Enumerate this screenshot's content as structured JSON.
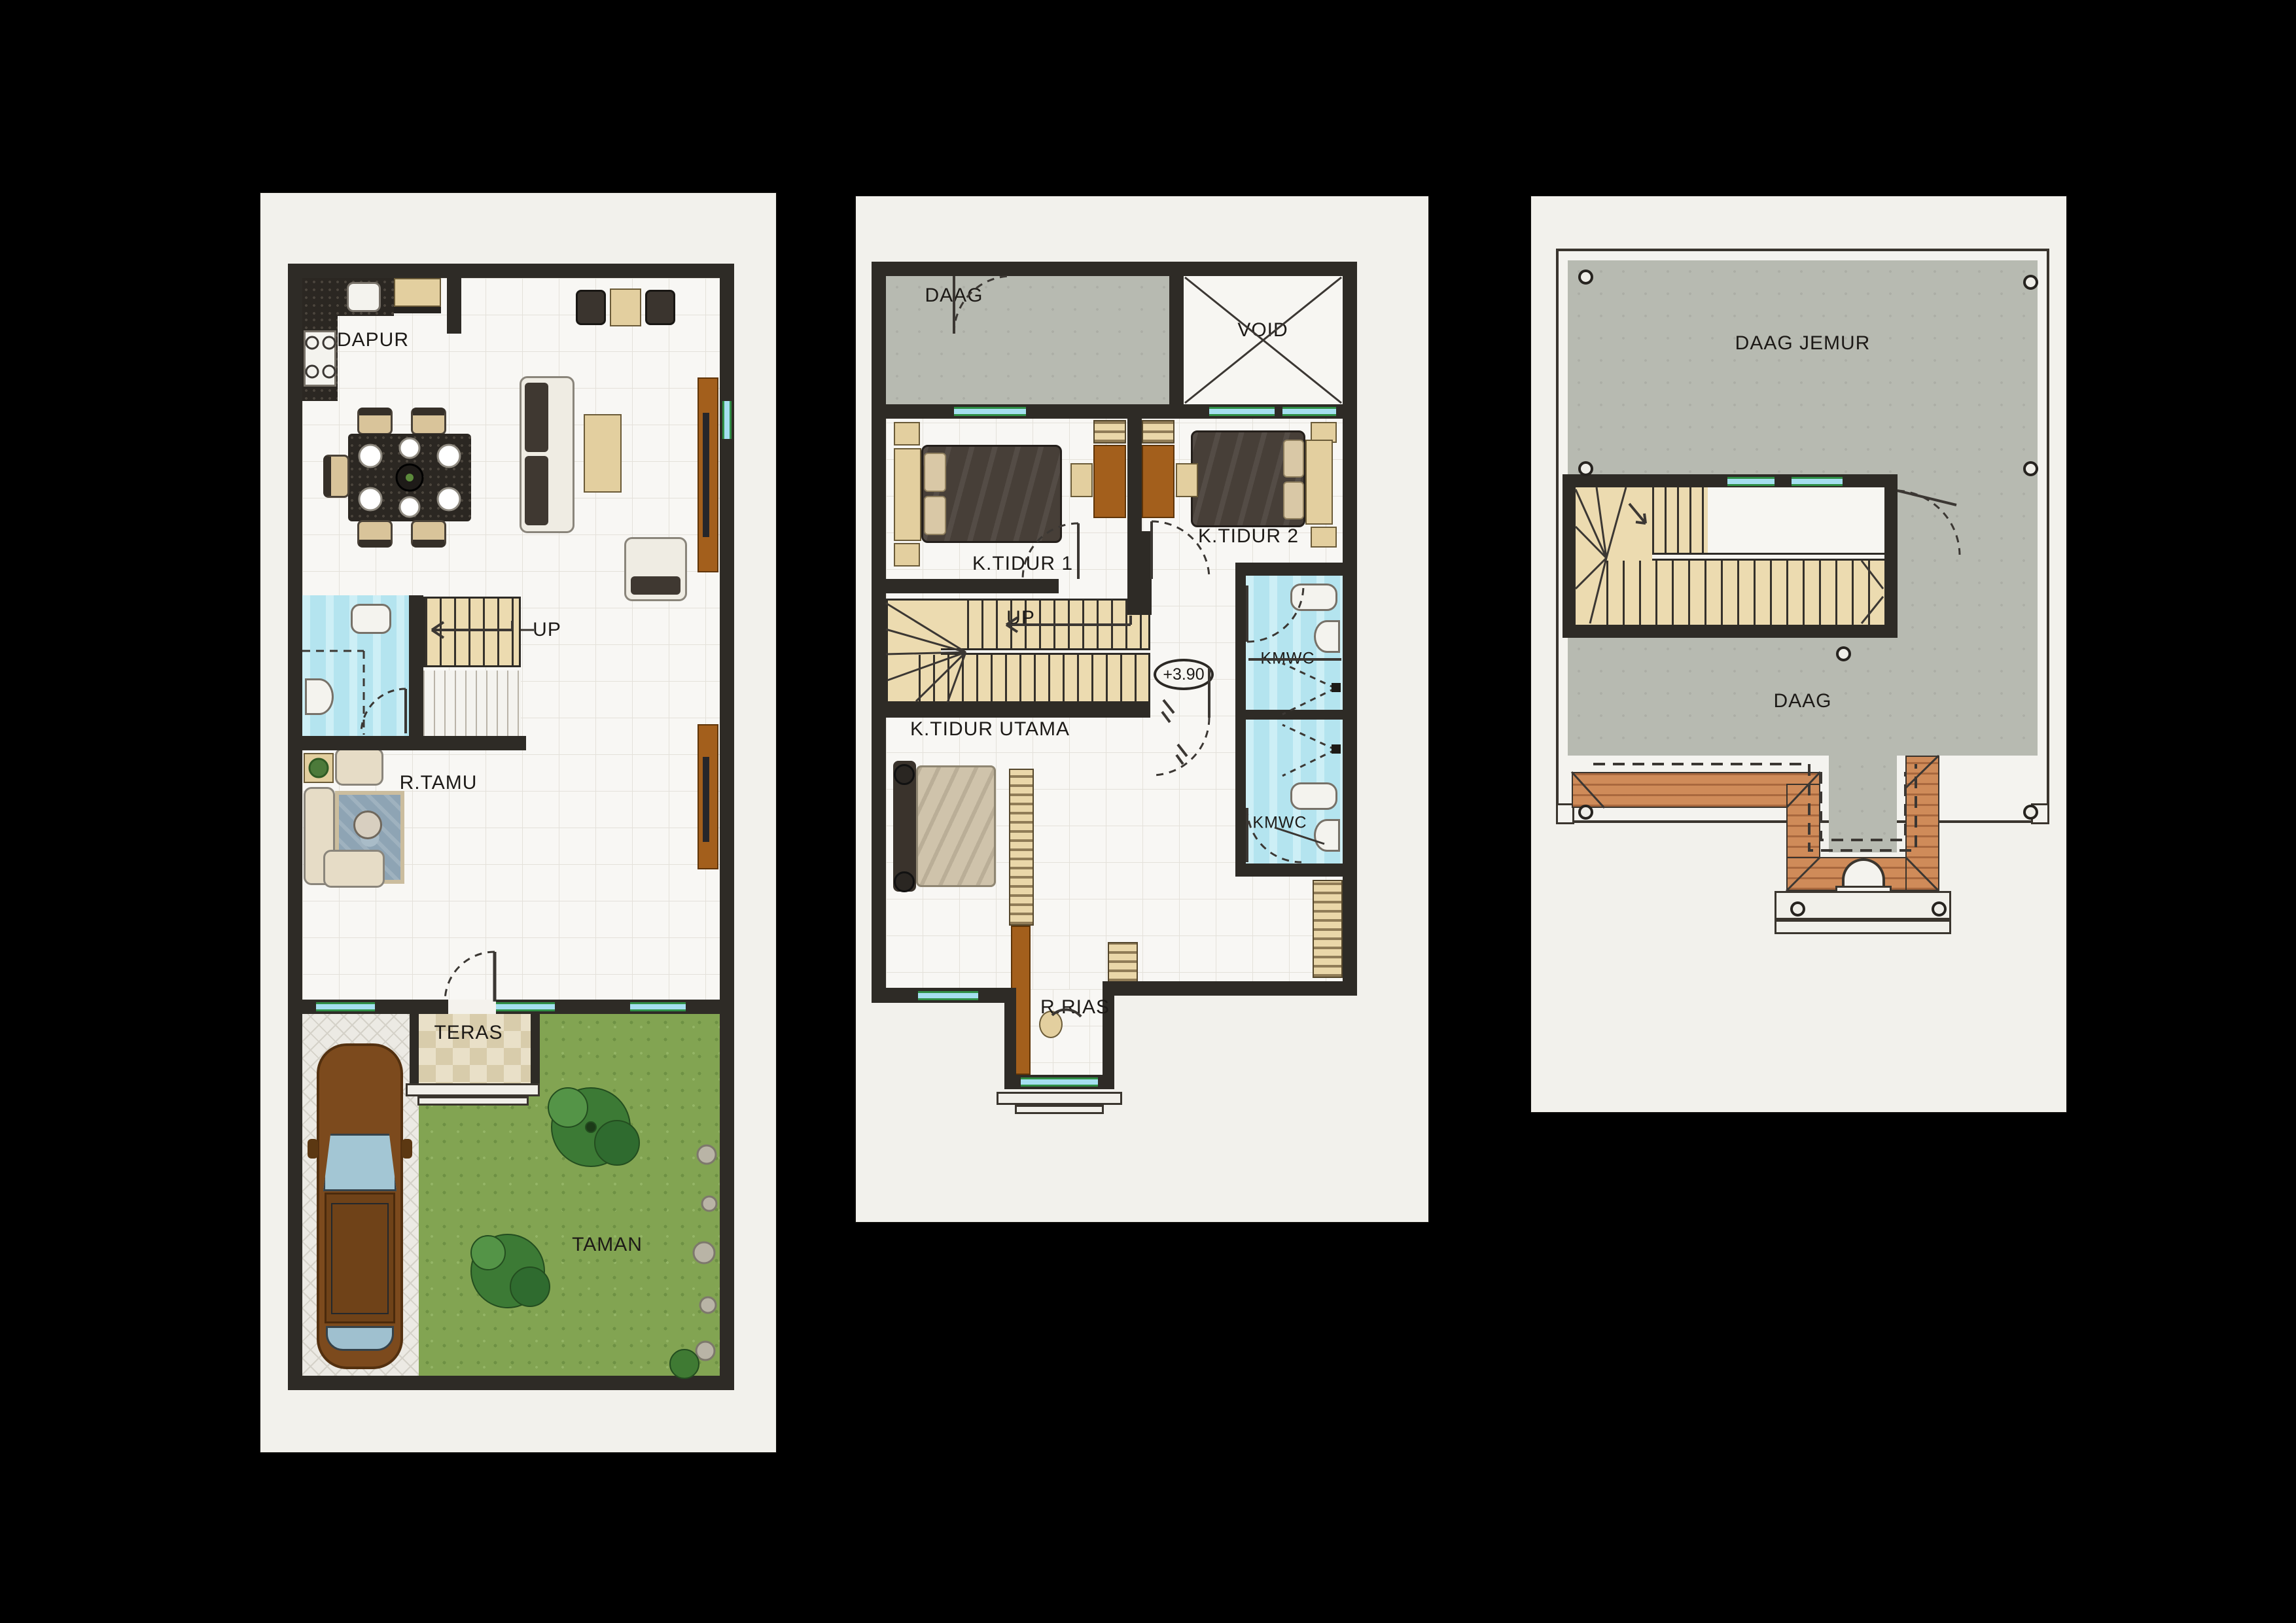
{
  "document_type": "house-floor-plan-sheet",
  "colors": {
    "background": "#000000",
    "paper": "#f2f1ec",
    "wall": "#2e2b26",
    "floor_grid": "#e4e1da",
    "bathroom_cyan": "#bfe9f2",
    "window_glass": "#a5dff0",
    "window_frame": "#2f8f46",
    "stair_tan": "#ecdbb0",
    "counter_granite": "#2b2722",
    "wood_brown": "#a35f1c",
    "bed_dark": "#473f38",
    "master_bed": "#cfc3ab",
    "concrete_gray": "#b7bab1",
    "terracotta_roof": "#cf8b59",
    "grass_green": "#82a452",
    "car_brown": "#7c4a1d",
    "rug_blue": "#8ea4b4"
  },
  "panels": [
    {
      "labels": {
        "dapur": "DAPUR",
        "up": "UP",
        "rtamu": "R.TAMU",
        "teras": "TERAS",
        "taman": "TAMAN"
      }
    },
    {
      "labels": {
        "daag": "DAAG",
        "void": "VOID",
        "ktidur1": "K.TIDUR 1",
        "ktidur2": "K.TIDUR 2",
        "up": "UP",
        "kmwc_upper": "KMWC",
        "ktidur_utama": "K.TIDUR UTAMA",
        "kmwc_lower": "KMWC",
        "rrias": "R.RIAS"
      },
      "elevation": "+3.90"
    },
    {
      "labels": {
        "daag_jemur": "DAAG JEMUR",
        "daag": "DAAG"
      }
    }
  ]
}
